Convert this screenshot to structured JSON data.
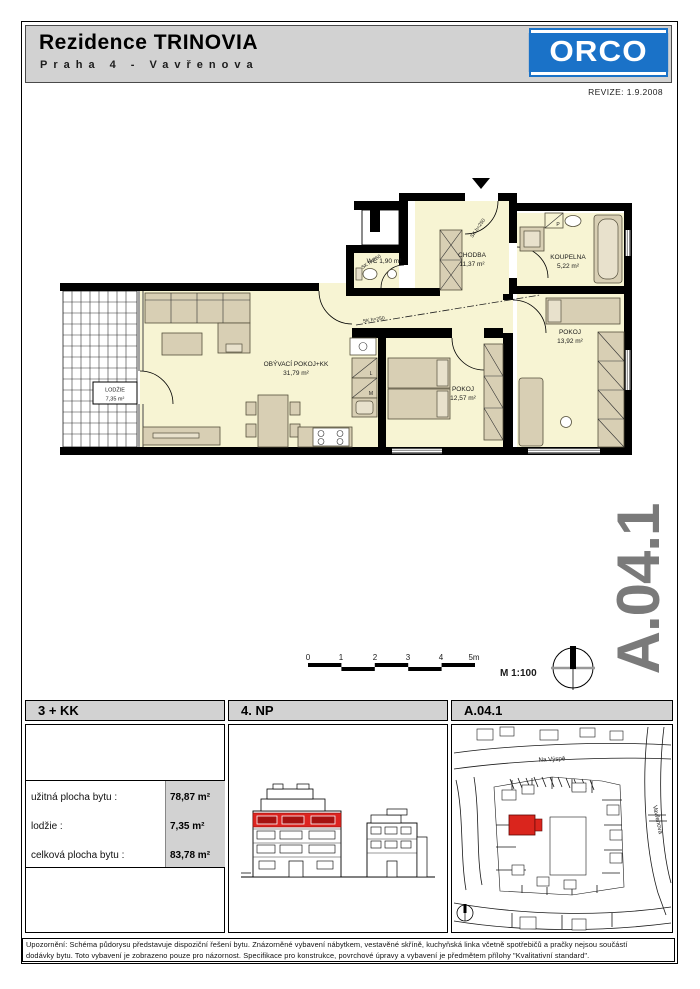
{
  "header": {
    "title": "Rezidence TRINOVIA",
    "subtitle": "Praha 4 - Vavřenova",
    "brand": "ORCO",
    "revision": "REVIZE: 1.9.2008"
  },
  "watermark": {
    "code": "A.04.1"
  },
  "summary": {
    "disposition": "3 + KK",
    "floor": "4. NP",
    "unit": "A.04.1"
  },
  "floor_plan": {
    "rooms": [
      {
        "name": "OBÝVACÍ POKOJ+KK",
        "area": "31,79 m²"
      },
      {
        "name": "CHODBA",
        "area": "11,37 m²"
      },
      {
        "name": "WC",
        "area": "1,90 m²"
      },
      {
        "name": "KOUPELNA",
        "area": "5,22 m²"
      },
      {
        "name": "POKOJ",
        "area": "12,57 m²"
      },
      {
        "name": "POKOJ",
        "area": "13,92 m²"
      },
      {
        "name": "LODŽIE",
        "area": "7,35 m²"
      }
    ],
    "annotations": {
      "sk": "SK h=250"
    },
    "appliances": {
      "fridge": "L",
      "freezer": "M",
      "washer": "P"
    },
    "scale": {
      "ticks": [
        "0",
        "1",
        "2",
        "3",
        "4",
        "5m"
      ],
      "label": "M 1:100"
    }
  },
  "areas": {
    "rows": [
      {
        "label": "užitná plocha bytu :",
        "value": "78,87 m²"
      },
      {
        "label": "lodžie :",
        "value": "7,35 m²"
      },
      {
        "label": "celková plocha bytu :",
        "value": "83,78 m²"
      }
    ]
  },
  "site_map": {
    "street_top": "Na Výspě",
    "street_right": "Vavřenova"
  },
  "disclaimer": {
    "line1": "Upozornění: Schéma půdorysu představuje dispoziční řešení bytu. Znázorněné vybavení nábytkem, vestavěné skříně, kuchyňská linka včetně spotřebičů a pračky nejsou součástí",
    "line2": "dodávky bytu. Toto vybavení je zobrazeno pouze pro názornost. Specifikace pro konstrukce, povrchové úpravy a vybavení je předmětem přílohy \"Kvalitativní standard\"."
  },
  "colors": {
    "orco_blue": "#1a72c8",
    "header_gray": "#d2d2d2",
    "floor_fill": "#f7f4d3",
    "furniture_fill": "#d8cfb4",
    "highlight_red": "#da251d",
    "watermark_gray": "#7a7a7a"
  }
}
